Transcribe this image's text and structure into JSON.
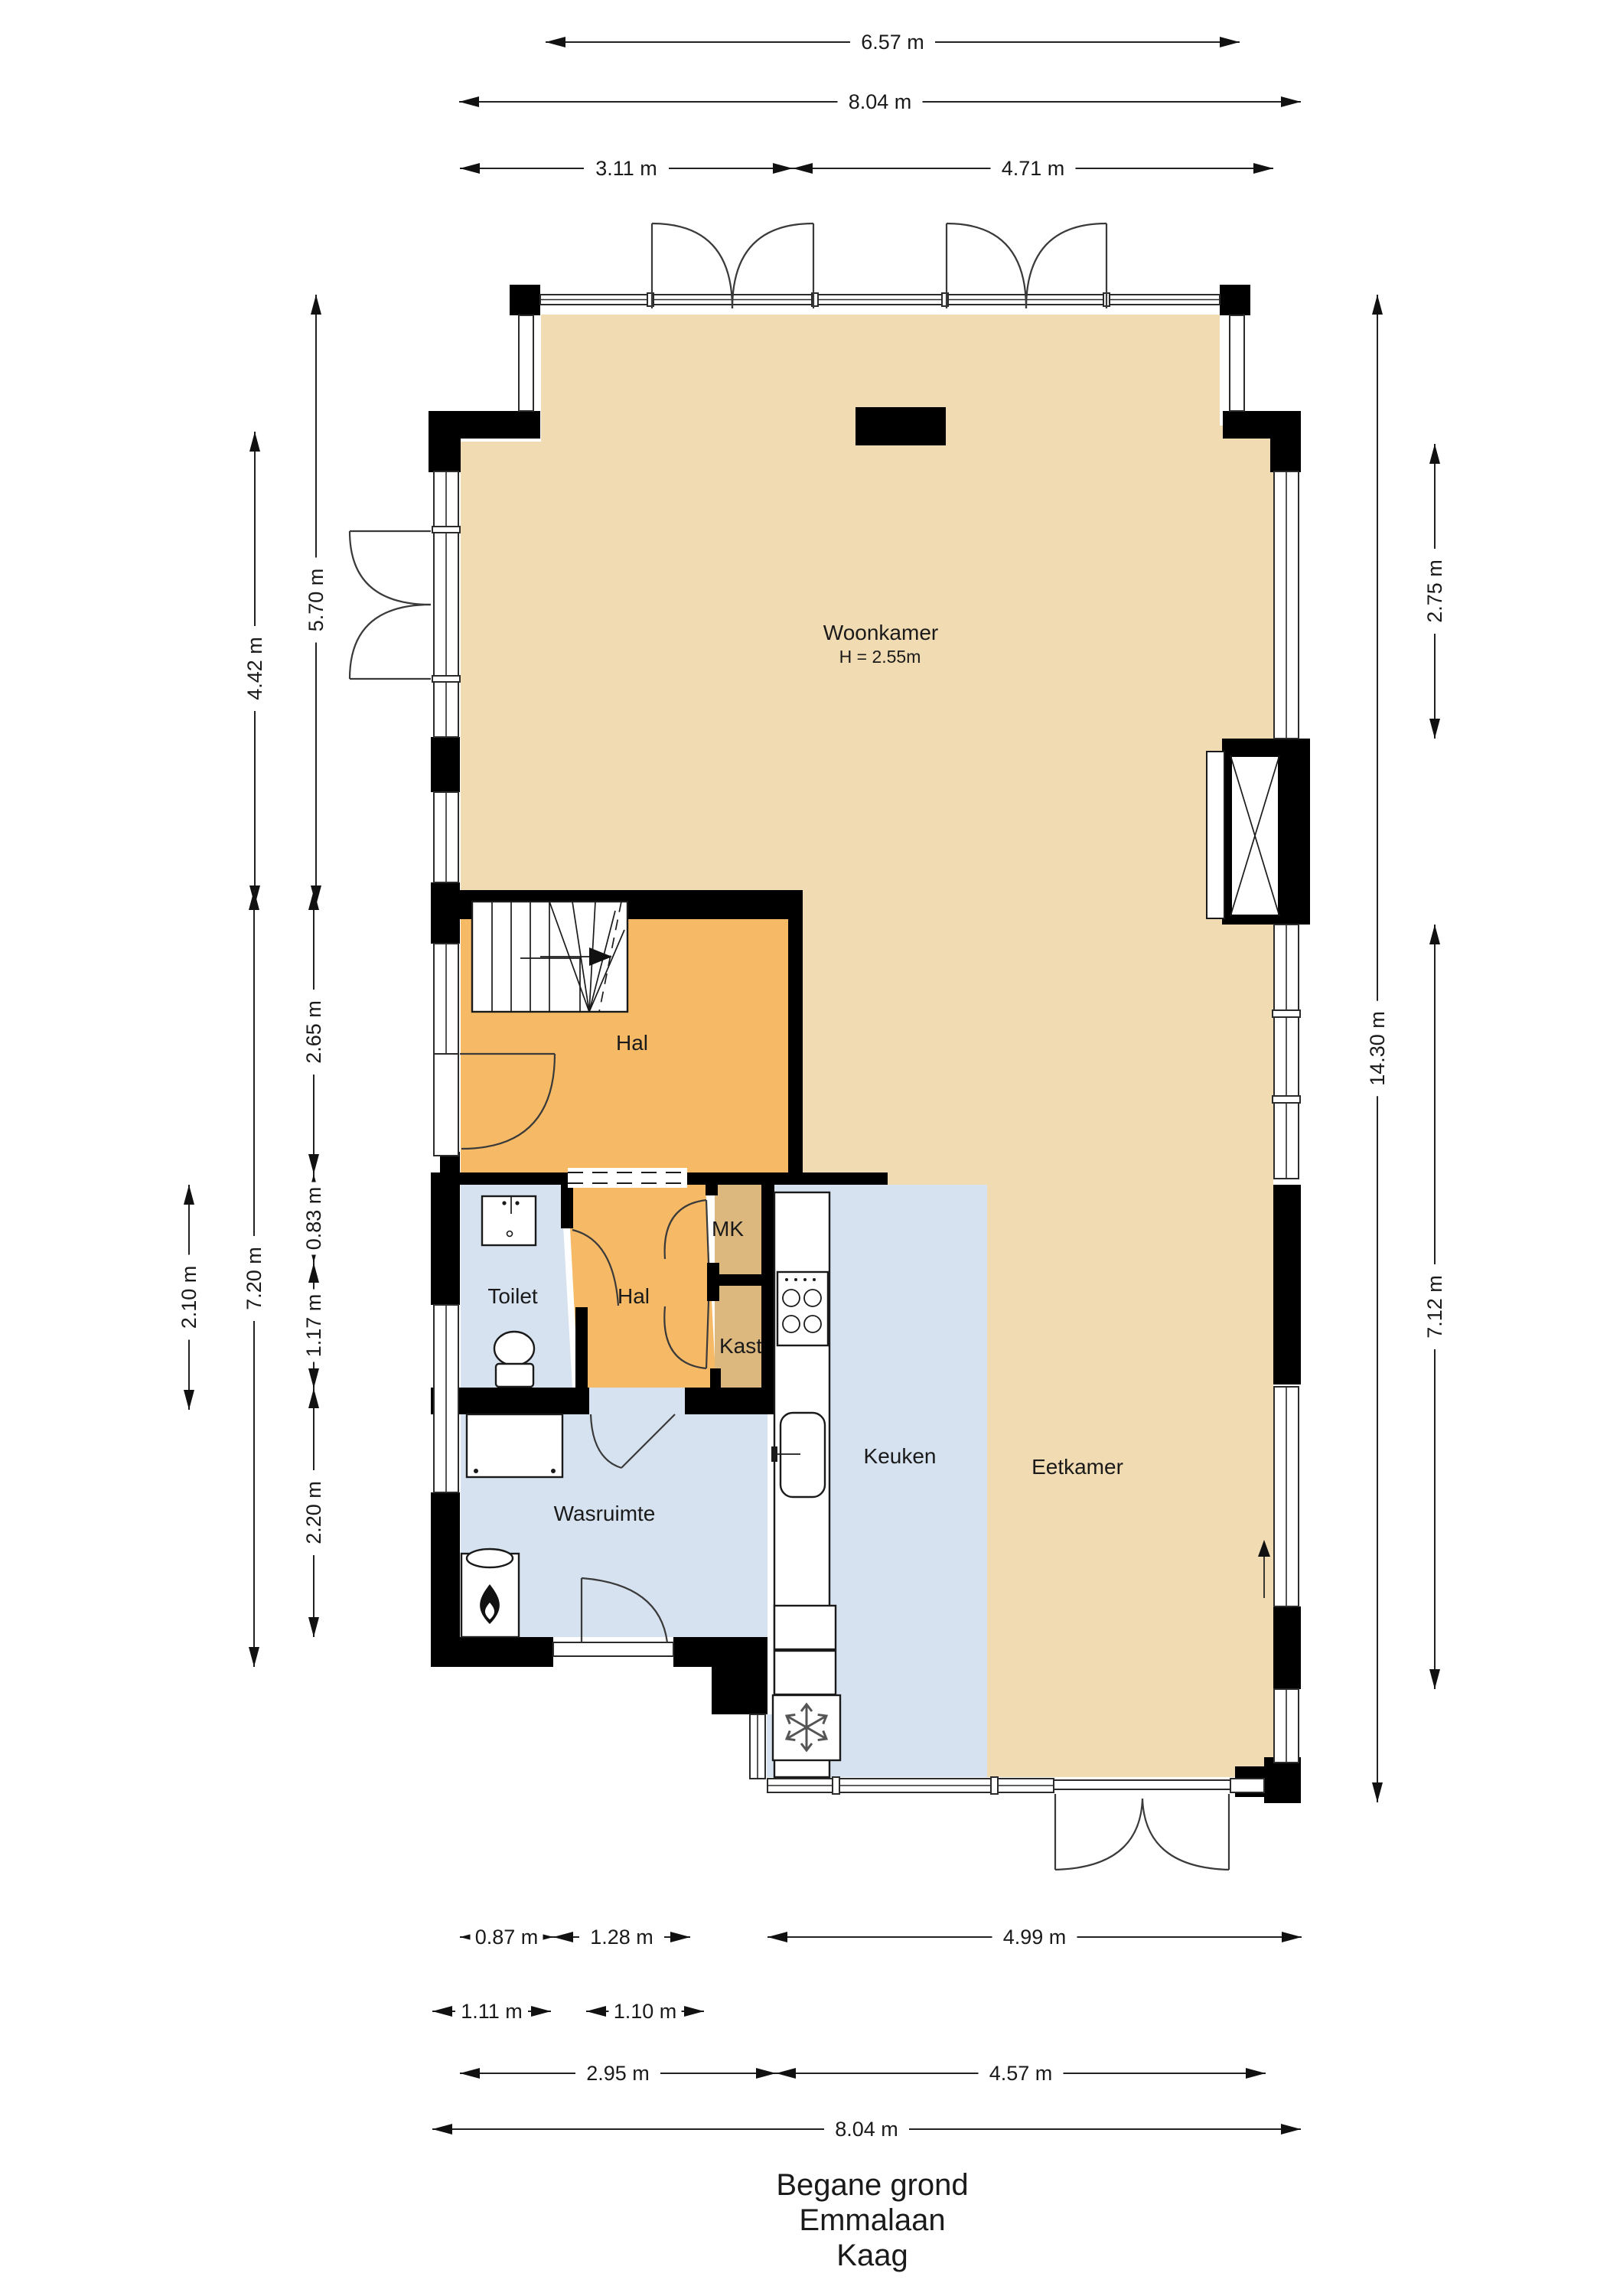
{
  "title": {
    "lines": [
      "Begane grond",
      "Emmalaan",
      "Kaag"
    ]
  },
  "rooms": [
    {
      "id": "woonkamer",
      "label": "Woonkamer",
      "sublabel": "H = 2.55m"
    },
    {
      "id": "hal_boven",
      "label": "Hal"
    },
    {
      "id": "hal_beneden",
      "label": "Hal"
    },
    {
      "id": "toilet",
      "label": "Toilet"
    },
    {
      "id": "mk",
      "label": "MK"
    },
    {
      "id": "kast",
      "label": "Kast"
    },
    {
      "id": "keuken",
      "label": "Keuken"
    },
    {
      "id": "eetkamer",
      "label": "Eetkamer"
    },
    {
      "id": "wasruimte",
      "label": "Wasruimte"
    }
  ],
  "dimensions": {
    "top": [
      {
        "id": "t1",
        "label": "6.57 m"
      },
      {
        "id": "t2",
        "label": "8.04 m"
      },
      {
        "id": "t3",
        "label": "3.11 m"
      },
      {
        "id": "t4",
        "label": "4.71 m"
      }
    ],
    "left": [
      {
        "id": "l1",
        "label": "5.70 m"
      },
      {
        "id": "l2",
        "label": "4.42 m"
      },
      {
        "id": "l3",
        "label": "2.65 m"
      },
      {
        "id": "l4",
        "label": "0.83 m"
      },
      {
        "id": "l5",
        "label": "1.17 m"
      },
      {
        "id": "l6",
        "label": "2.20 m"
      },
      {
        "id": "l7",
        "label": "7.20 m"
      },
      {
        "id": "l8",
        "label": "2.10 m"
      }
    ],
    "right": [
      {
        "id": "r1",
        "label": "2.75 m"
      },
      {
        "id": "r2",
        "label": "7.12 m"
      },
      {
        "id": "r3",
        "label": "14.30 m"
      }
    ],
    "bottom": [
      {
        "id": "b1",
        "label": "0.87 m"
      },
      {
        "id": "b2",
        "label": "1.28 m"
      },
      {
        "id": "b3",
        "label": "4.99 m"
      },
      {
        "id": "b4",
        "label": "1.11 m"
      },
      {
        "id": "b5",
        "label": "1.10 m"
      },
      {
        "id": "b6",
        "label": "2.95 m"
      },
      {
        "id": "b7",
        "label": "4.57 m"
      },
      {
        "id": "b8",
        "label": "8.04 m"
      }
    ]
  },
  "icons": {
    "boiler": "flame-icon",
    "freezer": "snowflake-icon",
    "stairs_direction": "arrow-right-icon",
    "window_opening": "arrow-up-icon"
  },
  "colors": {
    "wall": "#000000",
    "floor_living": "#F1DBB2",
    "floor_hall": "#F6BA67",
    "floor_wet": "#D6E2EF",
    "floor_closet": "#DCB77E",
    "dimension_line": "#222222"
  }
}
